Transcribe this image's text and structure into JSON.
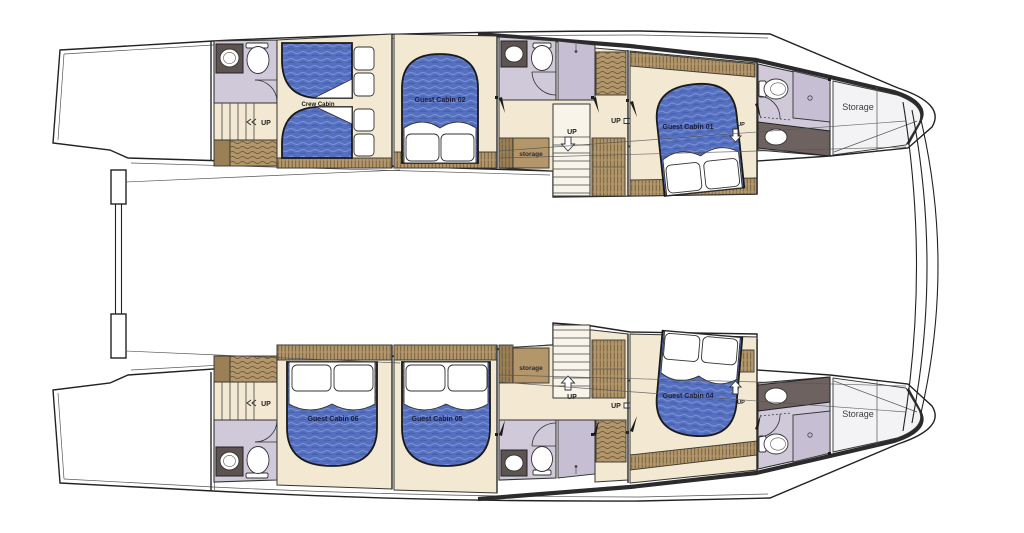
{
  "diagram": {
    "kind": "catamaran-lower-deck-floor-plan",
    "background": "#ffffff"
  },
  "colors": {
    "hull_line": "#222222",
    "floor_beige": "#f3e9d2",
    "bathroom_lavender": "#cfc9d9",
    "shower_lavender": "#c6bed2",
    "wood_tan": "#b3976b",
    "wood_dark": "#9b7f55",
    "counter_dark": "#6e6260",
    "fixture_dark": "#5d5451",
    "bed_blue": "#5570c0",
    "storage_floor": "#f3f2f5",
    "label_navy": "#1b1b3a"
  },
  "labels": {
    "crew_cabin": "Crew Cabin",
    "guest_cabin_01": "Guest Cabin 01",
    "guest_cabin_02": "Guest Cabin 02",
    "guest_cabin_04": "Guest Cabin 04",
    "guest_cabin_05": "Guest Cabin 05",
    "guest_cabin_06": "Guest Cabin 06",
    "storage_companionway": "storage",
    "storage_aft": "Storage",
    "up": "UP"
  }
}
